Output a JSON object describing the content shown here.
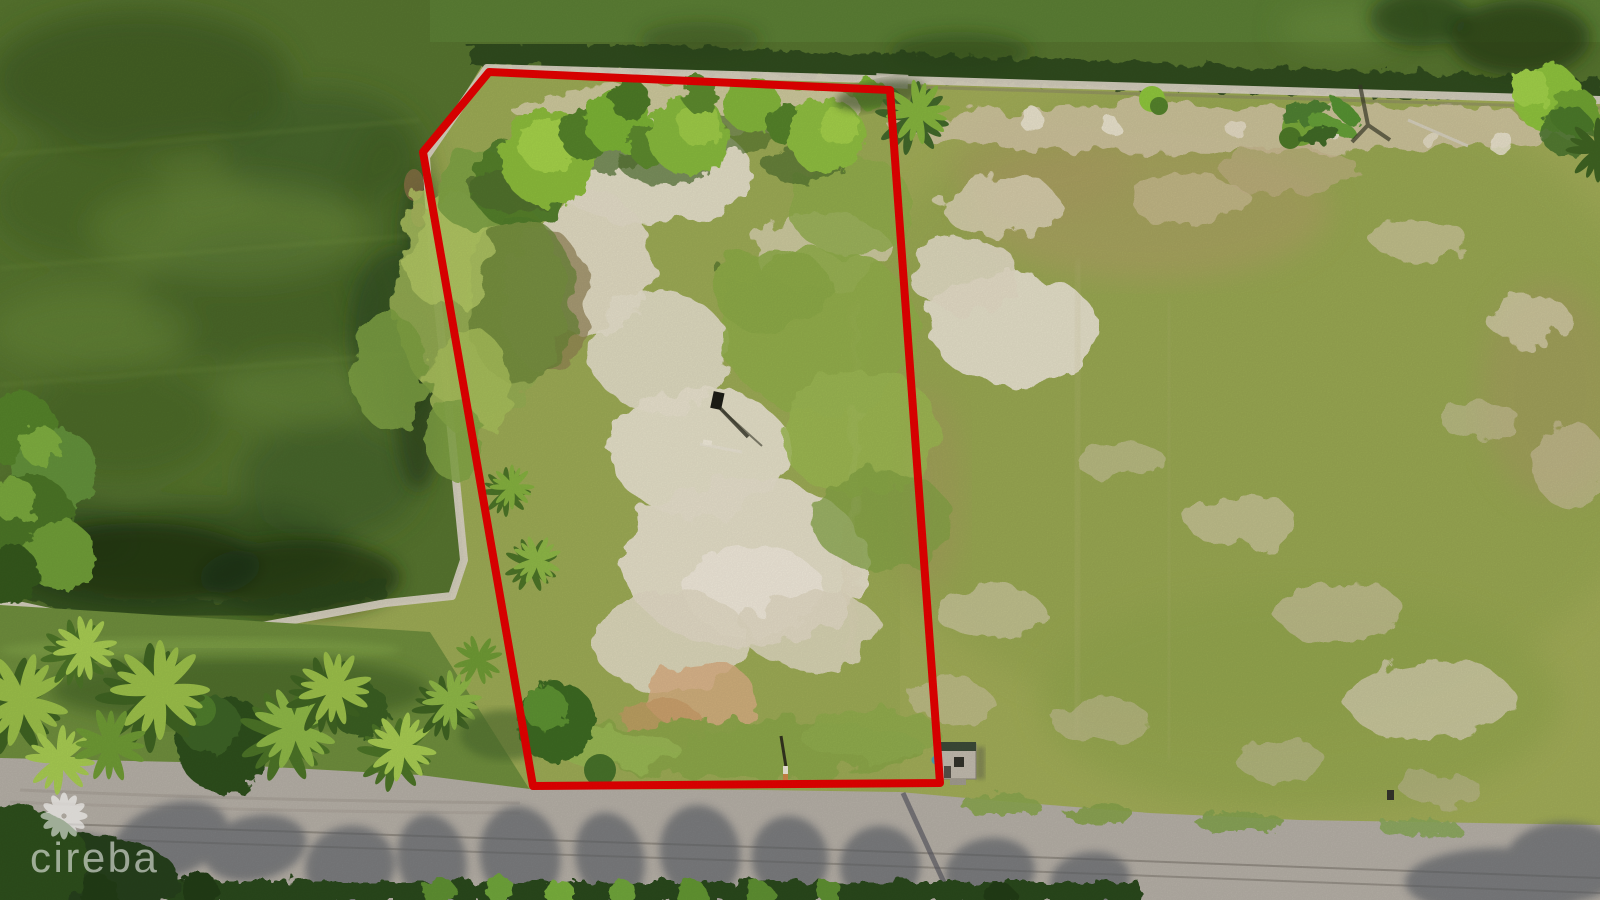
{
  "photo": {
    "type": "aerial-drone-photograph",
    "subject": "Vacant canal-front land parcel outlined in red",
    "scene": {
      "water": "murky green pond and canal along the top and left",
      "parcel": "cleared lot with grass, white sand patches, bright bushes and casuarina trees",
      "adjacent_field": "large grassy field with sandy patches to the right of the parcel",
      "road": "gray paved road with tree shadows along the bottom edge",
      "shed": "small utility shed at the bottom-right boundary corner",
      "palms": "row of coconut palms between the pond and the road"
    }
  },
  "boundary": {
    "color": "#e60000",
    "stroke_width": 8,
    "points": "489,72 890,90 940,783 533,786 423,152"
  },
  "watermark": {
    "text": "cireba",
    "icon": "flower-icon",
    "color": "#ffffff",
    "opacity": 0.55
  },
  "palette": {
    "pond_water": "#57752f",
    "canal_water": "#5d8136",
    "field_grass": "#9dab55",
    "sand": "#e6dfcb",
    "road_asphalt": "#b6b0a7",
    "seawall": "#d9d2c3",
    "hedge_dark_green": "#2c481c",
    "palm_bright_green": "#9cc04a"
  }
}
